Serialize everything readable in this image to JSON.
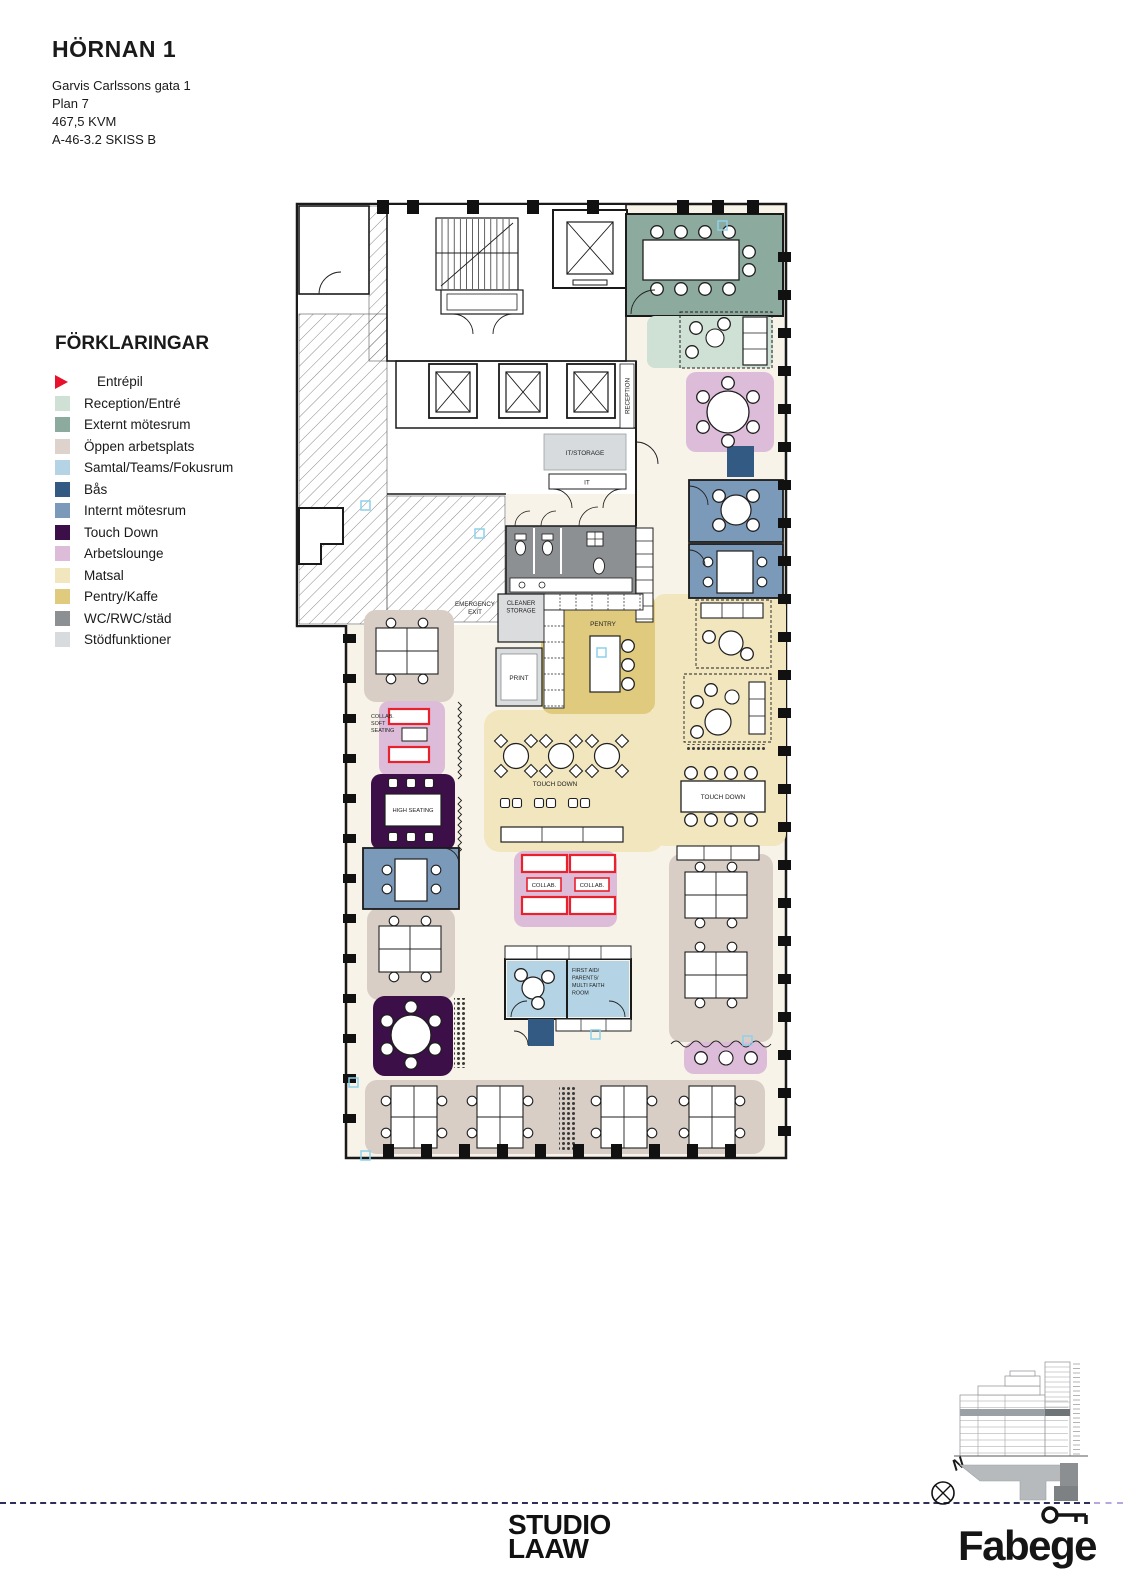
{
  "document": {
    "title": "HÖRNAN 1",
    "address": "Garvis Carlssons gata 1",
    "floor": "Plan 7",
    "area": "467,5 KVM",
    "drawing_no": "A-46-3.2 SKISS B"
  },
  "legend": {
    "title": "FÖRKLARINGAR",
    "items": [
      {
        "label": "Entrépil",
        "type": "arrow",
        "color_key": "entrepil"
      },
      {
        "label": "Reception/Entré",
        "type": "swatch",
        "color_key": "reception"
      },
      {
        "label": "Externt mötesrum",
        "type": "swatch",
        "color_key": "externt"
      },
      {
        "label": "Öppen arbetsplats",
        "type": "swatch",
        "color_key": "oppen_legend"
      },
      {
        "label": "Samtal/Teams/Fokusrum",
        "type": "swatch",
        "color_key": "samtal"
      },
      {
        "label": "Bås",
        "type": "swatch",
        "color_key": "bas"
      },
      {
        "label": "Internt mötesrum",
        "type": "swatch",
        "color_key": "internt"
      },
      {
        "label": "Touch Down",
        "type": "swatch",
        "color_key": "touchdown"
      },
      {
        "label": "Arbetslounge",
        "type": "swatch",
        "color_key": "arbetslounge"
      },
      {
        "label": "Matsal",
        "type": "swatch",
        "color_key": "matsal"
      },
      {
        "label": "Pentry/Kaffe",
        "type": "swatch",
        "color_key": "pentry"
      },
      {
        "label": "WC/RWC/städ",
        "type": "swatch",
        "color_key": "wc"
      },
      {
        "label": "Stödfunktioner",
        "type": "swatch",
        "color_key": "stod"
      }
    ]
  },
  "colors": {
    "entrepil": "#e8112d",
    "reception": "#cfe0d5",
    "externt": "#8caa9d",
    "oppen_legend": "#ded2cc",
    "oppen": "#d9cec6",
    "samtal": "#b4d4e6",
    "bas": "#335a82",
    "internt": "#7b99b8",
    "touchdown": "#3c0f49",
    "arbetslounge": "#dcbcd8",
    "matsal": "#f1e6bd",
    "pentry": "#e0ca7e",
    "wc": "#8d9093",
    "stod": "#d7dbdd",
    "floor": "#f8f3e8",
    "collab_red": "#e8212d"
  },
  "plan": {
    "labels": {
      "reception": "RECEPTION",
      "it_storage": "IT/STORAGE",
      "it": "IT",
      "pentry": "PENTRY",
      "print": "PRINT",
      "cleaner_1": "CLEANER",
      "cleaner_2": "STORAGE",
      "emergency_1": "EMERGENCY",
      "emergency_2": "EXIT",
      "touch_down_center": "TOUCH DOWN",
      "touch_down_right": "TOUCH DOWN",
      "high_seating": "HIGH SEATING",
      "collab_soft_1": "COLLAB.",
      "collab_soft_2": "SOFT",
      "collab_soft_3": "SEATING",
      "collab_a": "COLLAB.",
      "collab_b": "COLLAB.",
      "first_aid_1": "FIRST AID/",
      "first_aid_2": "PARENTS/",
      "first_aid_3": "MULTI FAITH",
      "first_aid_4": "ROOM"
    }
  },
  "footer": {
    "studio_line1": "STUDIO",
    "studio_line2": "LAAW",
    "fabege": "Fabege",
    "north_label": "N"
  }
}
